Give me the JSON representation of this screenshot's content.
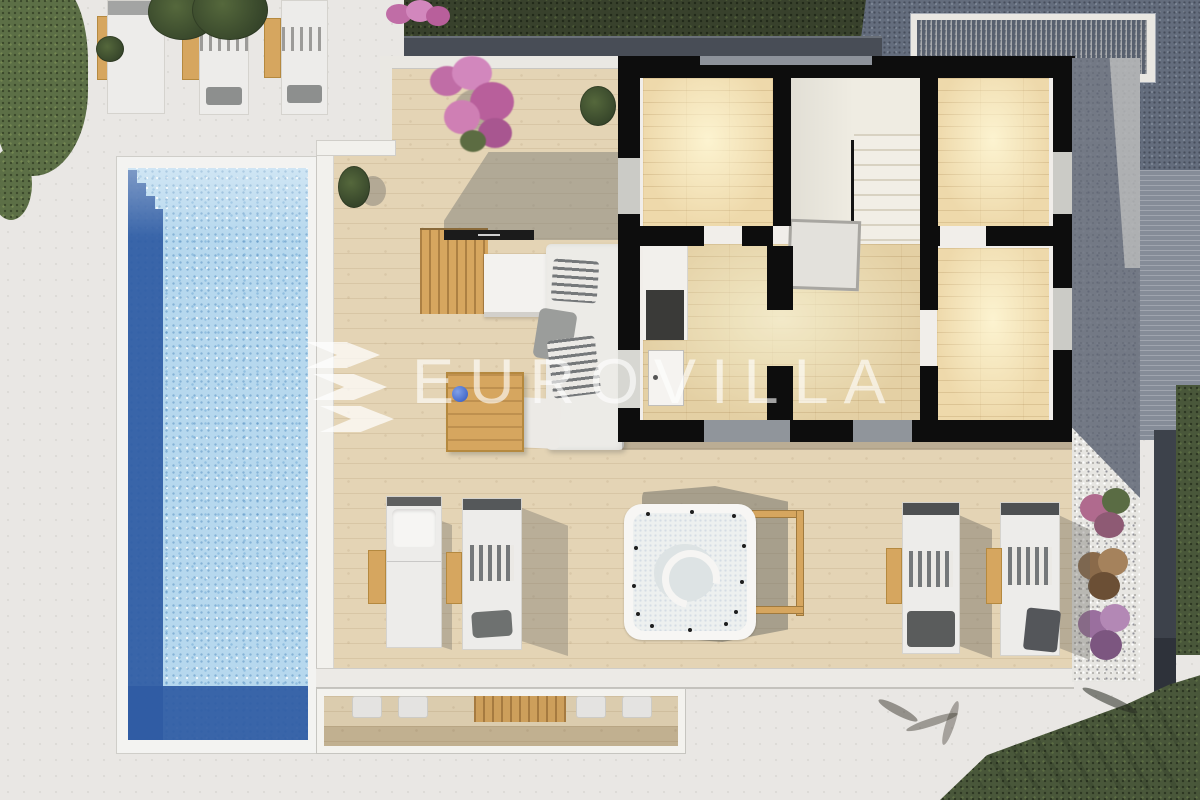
{
  "watermark": {
    "text": "EUROVILLA",
    "logo": "triple-chevron-logo"
  },
  "colors": {
    "concrete": "#e9e7e4",
    "deck_wood": "#e4d4b5",
    "interior_wood": "#eed9ab",
    "pool_light": "#b6d8ee",
    "pool_dark": "#2f5ba4",
    "wall_black": "#0d0d0d",
    "grass_dark": "#38412c",
    "grass_mid": "#49573a",
    "grass_light": "#5c6f46",
    "paving": "#646d7d",
    "gravel_white": "#e7e6e2",
    "furniture_wood": "#d6a65f",
    "watermark_white": "rgba(255,255,255,0.62)"
  }
}
